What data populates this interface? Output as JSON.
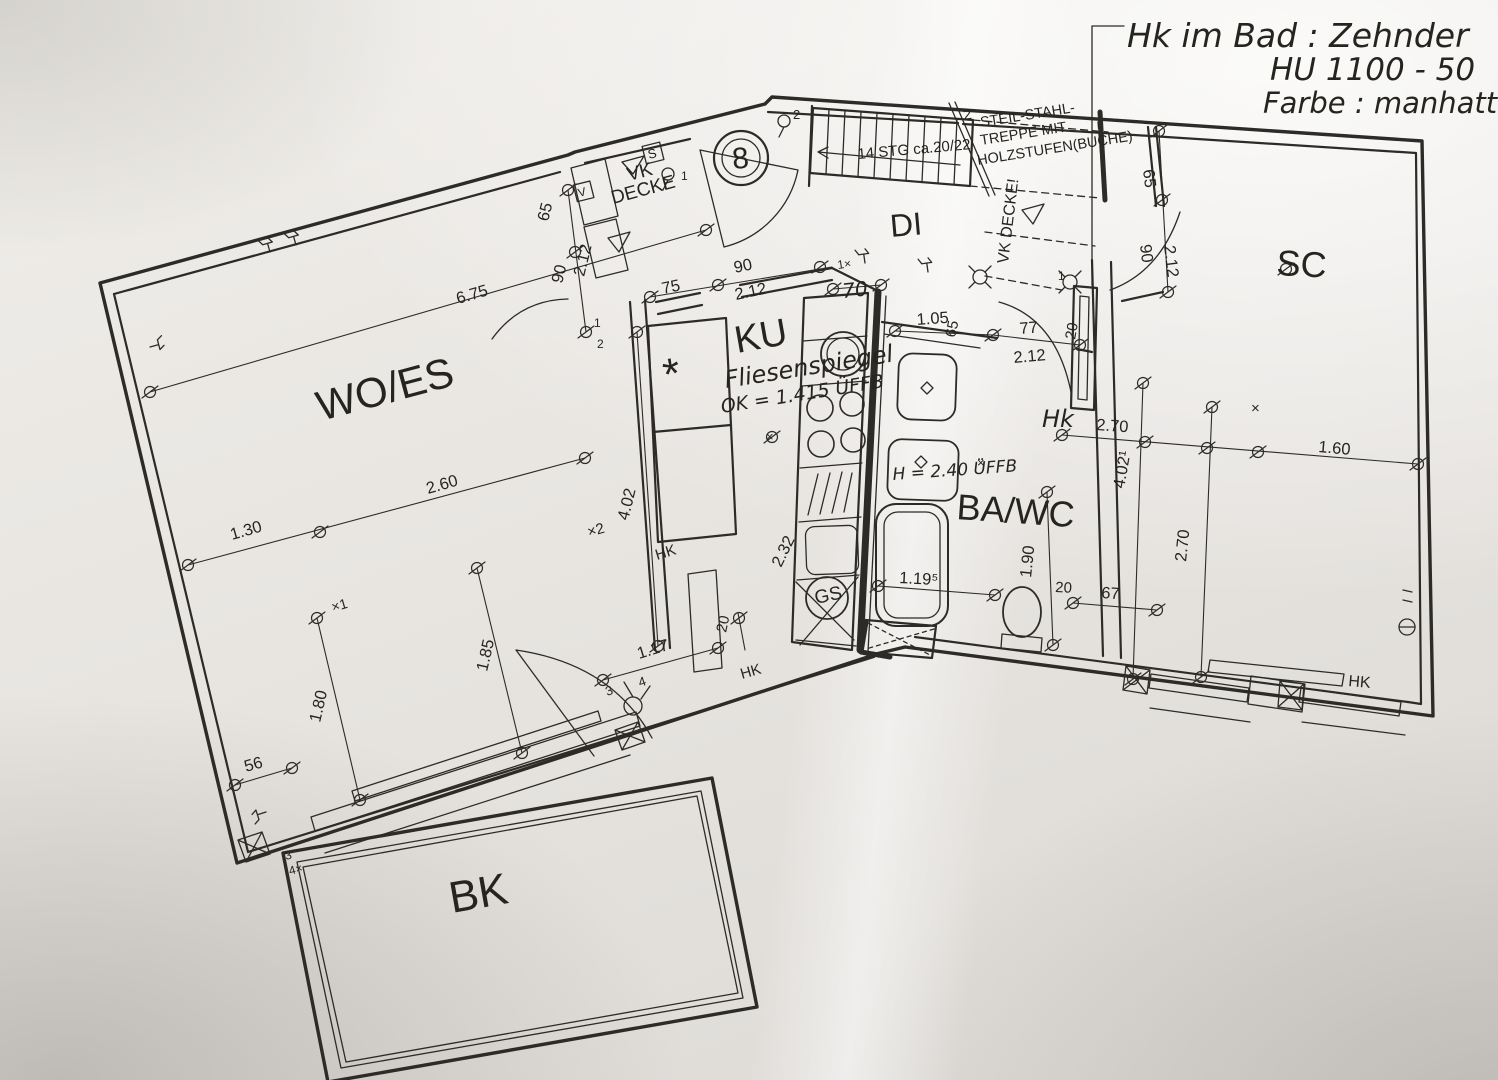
{
  "handwritten": {
    "bad_note_line1": "Hk im Bad : Zehnder",
    "bad_note_line2": "HU 1100 - 50",
    "bad_note_line3": "Farbe : manhattan",
    "fliesenspiegel_line1": "Fliesenspiegel",
    "fliesenspiegel_line2": "OK = 1.415 ÜFFB",
    "height_note": "H = 2.40 ÜFFB",
    "hk_bad": "Hk"
  },
  "rooms": {
    "wo_es": "WO/ES",
    "ku": "KU",
    "di": "DI",
    "ba_wc": "BA/WC",
    "sc": "SC",
    "bk": "BK"
  },
  "stairs": {
    "steps": "14 STG  ca.20/22",
    "note_num": "2",
    "note_line1": "STEIL-STAHL-",
    "note_line2": "TREPPE MIT",
    "note_line3": "HOLZSTUFEN(BUCHE)",
    "vk_decke": "VK DECKE!"
  },
  "notes": {
    "vk": "VK",
    "decke": "DECKE",
    "hk": "HK",
    "gs": "GS",
    "star": "*",
    "s_box": "S",
    "v_box": "V",
    "circle_8": "8"
  },
  "dims": {
    "d_675": "6.75",
    "d_260": "2.60",
    "d_130": "1.30",
    "d_180": "1.80",
    "d_185": "1.85",
    "d_56": "56",
    "d_117": "1.17",
    "d_402": "4.02",
    "d_402_1": "4.02¹",
    "d_232": "2.32",
    "d_212": "2.12",
    "d_75": "75",
    "d_90": "90",
    "d_65": "65",
    "d_70": "70",
    "d_105": "1.05",
    "d_77": "77",
    "d_270": "2.70",
    "d_160": "1.60",
    "d_119_5": "1.19⁵",
    "d_190": "1.90",
    "d_20": "20",
    "d_67": "67"
  },
  "marks": {
    "x1": "×1",
    "x2": "×2",
    "x": "×",
    "one_x": "1×",
    "n1": "1",
    "n2": "2",
    "n3": "3",
    "n4": "4",
    "n4x": "4×"
  }
}
